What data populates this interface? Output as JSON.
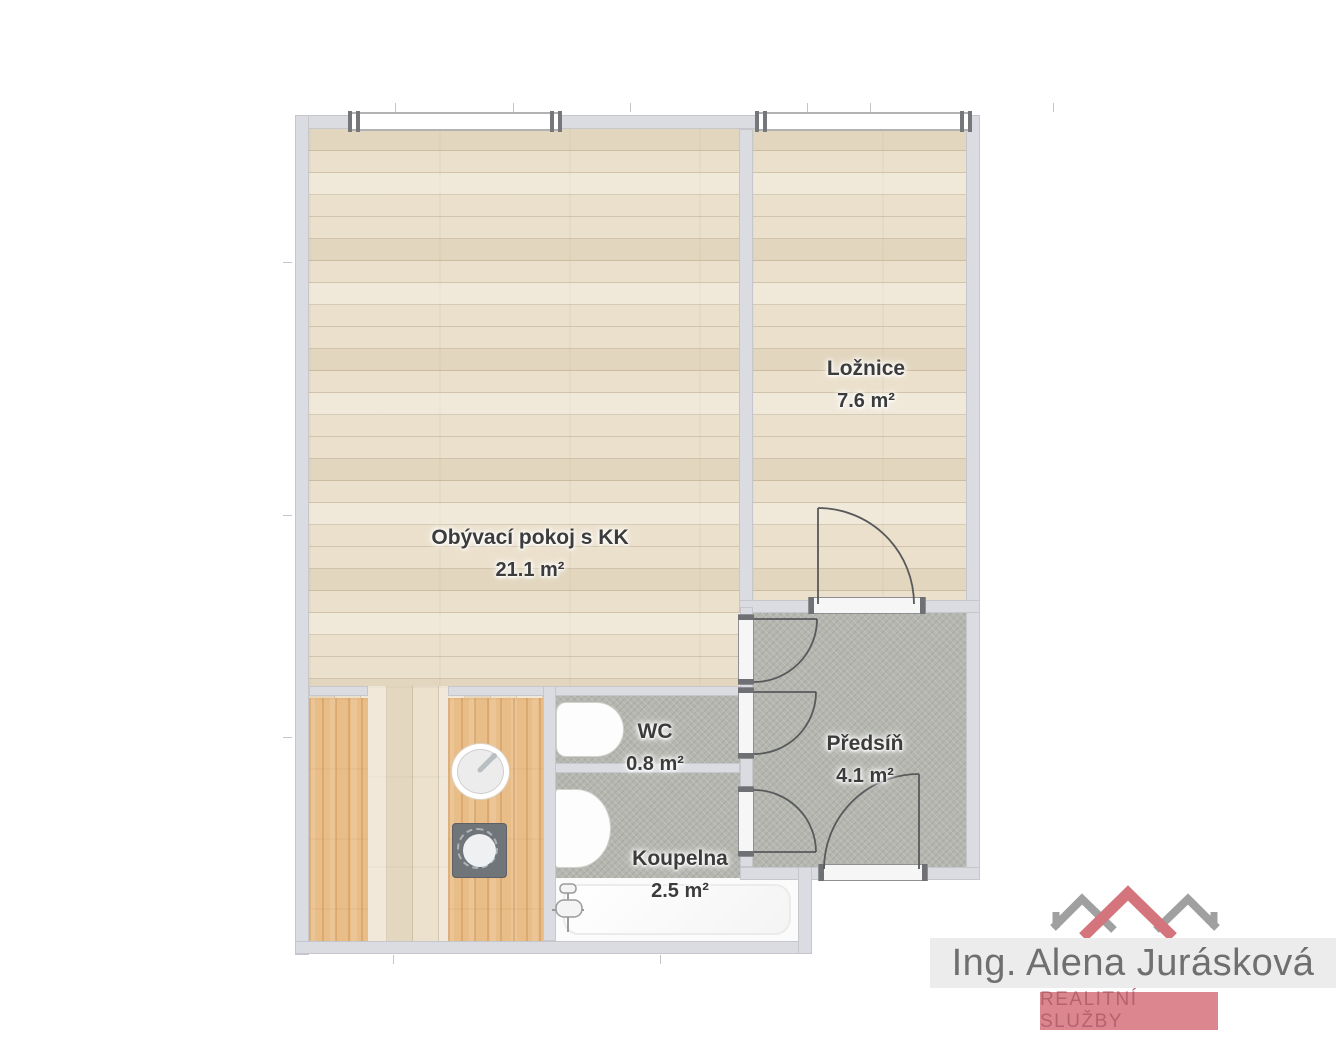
{
  "floorplan": {
    "rooms": [
      {
        "name": "Obývací pokoj s KK",
        "area": "21.1 m²"
      },
      {
        "name": "Ložnice",
        "area": "7.6 m²"
      },
      {
        "name": "WC",
        "area": "0.8 m²"
      },
      {
        "name": "Koupelna",
        "area": "2.5 m²"
      },
      {
        "name": "Předsíň",
        "area": "4.1 m²"
      }
    ],
    "fixtures": [
      "toilet",
      "washbasin",
      "bathtub",
      "kitchen-sink",
      "cooktop",
      "kitchen-counters"
    ],
    "colors": {
      "wood_floor": "#ebe0cb",
      "counter_wood": "#e9bd87",
      "tile_floor": "#b4b6af",
      "wall": "#dadce1"
    }
  },
  "branding": {
    "agent_name": "Ing. Alena Jurásková",
    "tagline": "REALITNÍ SLUŽBY",
    "colors": {
      "roof_red": "#d4747c",
      "roof_gray": "#a0a0a0",
      "band_bg": "#ececec",
      "name_text": "#6f6f6f",
      "badge_bg": "#dc8790",
      "badge_text": "#b5626f"
    }
  }
}
